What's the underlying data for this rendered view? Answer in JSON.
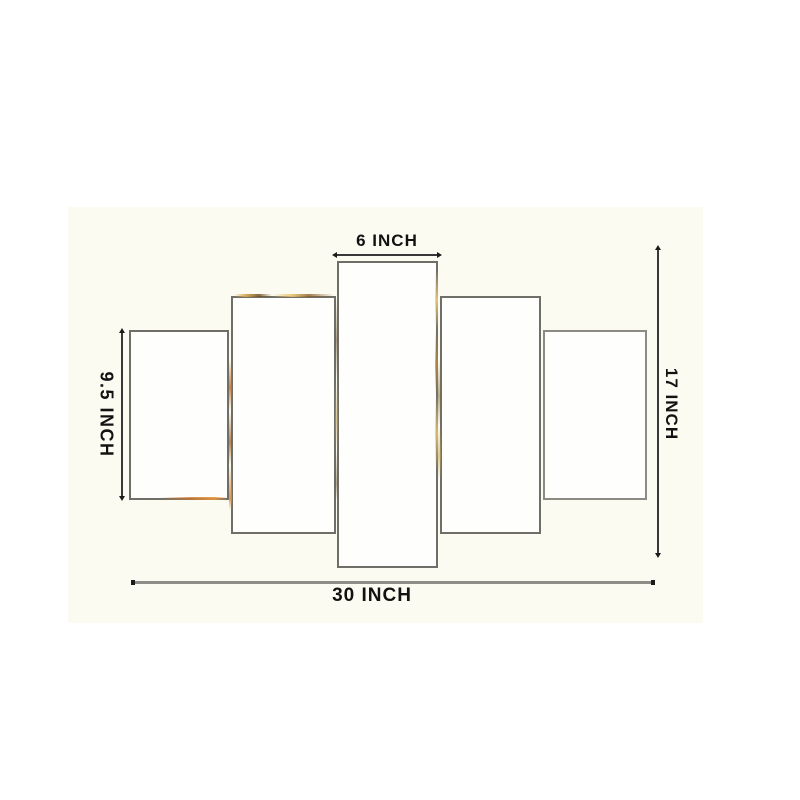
{
  "meta": {
    "description": "Product dimension diagram of a 5-panel wall painting set",
    "panel_count": 5
  },
  "colors": {
    "page_bg": "#ffffff",
    "photo_bg": "#fcfbf1",
    "panel_bg": "#fefefd",
    "panel_border": "#6f6f68",
    "panel_border_light": "#8b8b84",
    "line_dark": "#39393a",
    "line_gray": "#8e8e88",
    "tick_dark": "#1c1c1c",
    "text": "#121212",
    "fleck_gold": "#d6a853",
    "fleck_orange": "#c4702a"
  },
  "dimensions": {
    "top": {
      "label": "6 INCH",
      "measures": "center panel width"
    },
    "left": {
      "label": "9.5 INCH",
      "measures": "outer panel height"
    },
    "right": {
      "label": "17 INCH",
      "measures": "overall set height"
    },
    "bottom": {
      "label": "30 INCH",
      "measures": "overall set width"
    }
  }
}
